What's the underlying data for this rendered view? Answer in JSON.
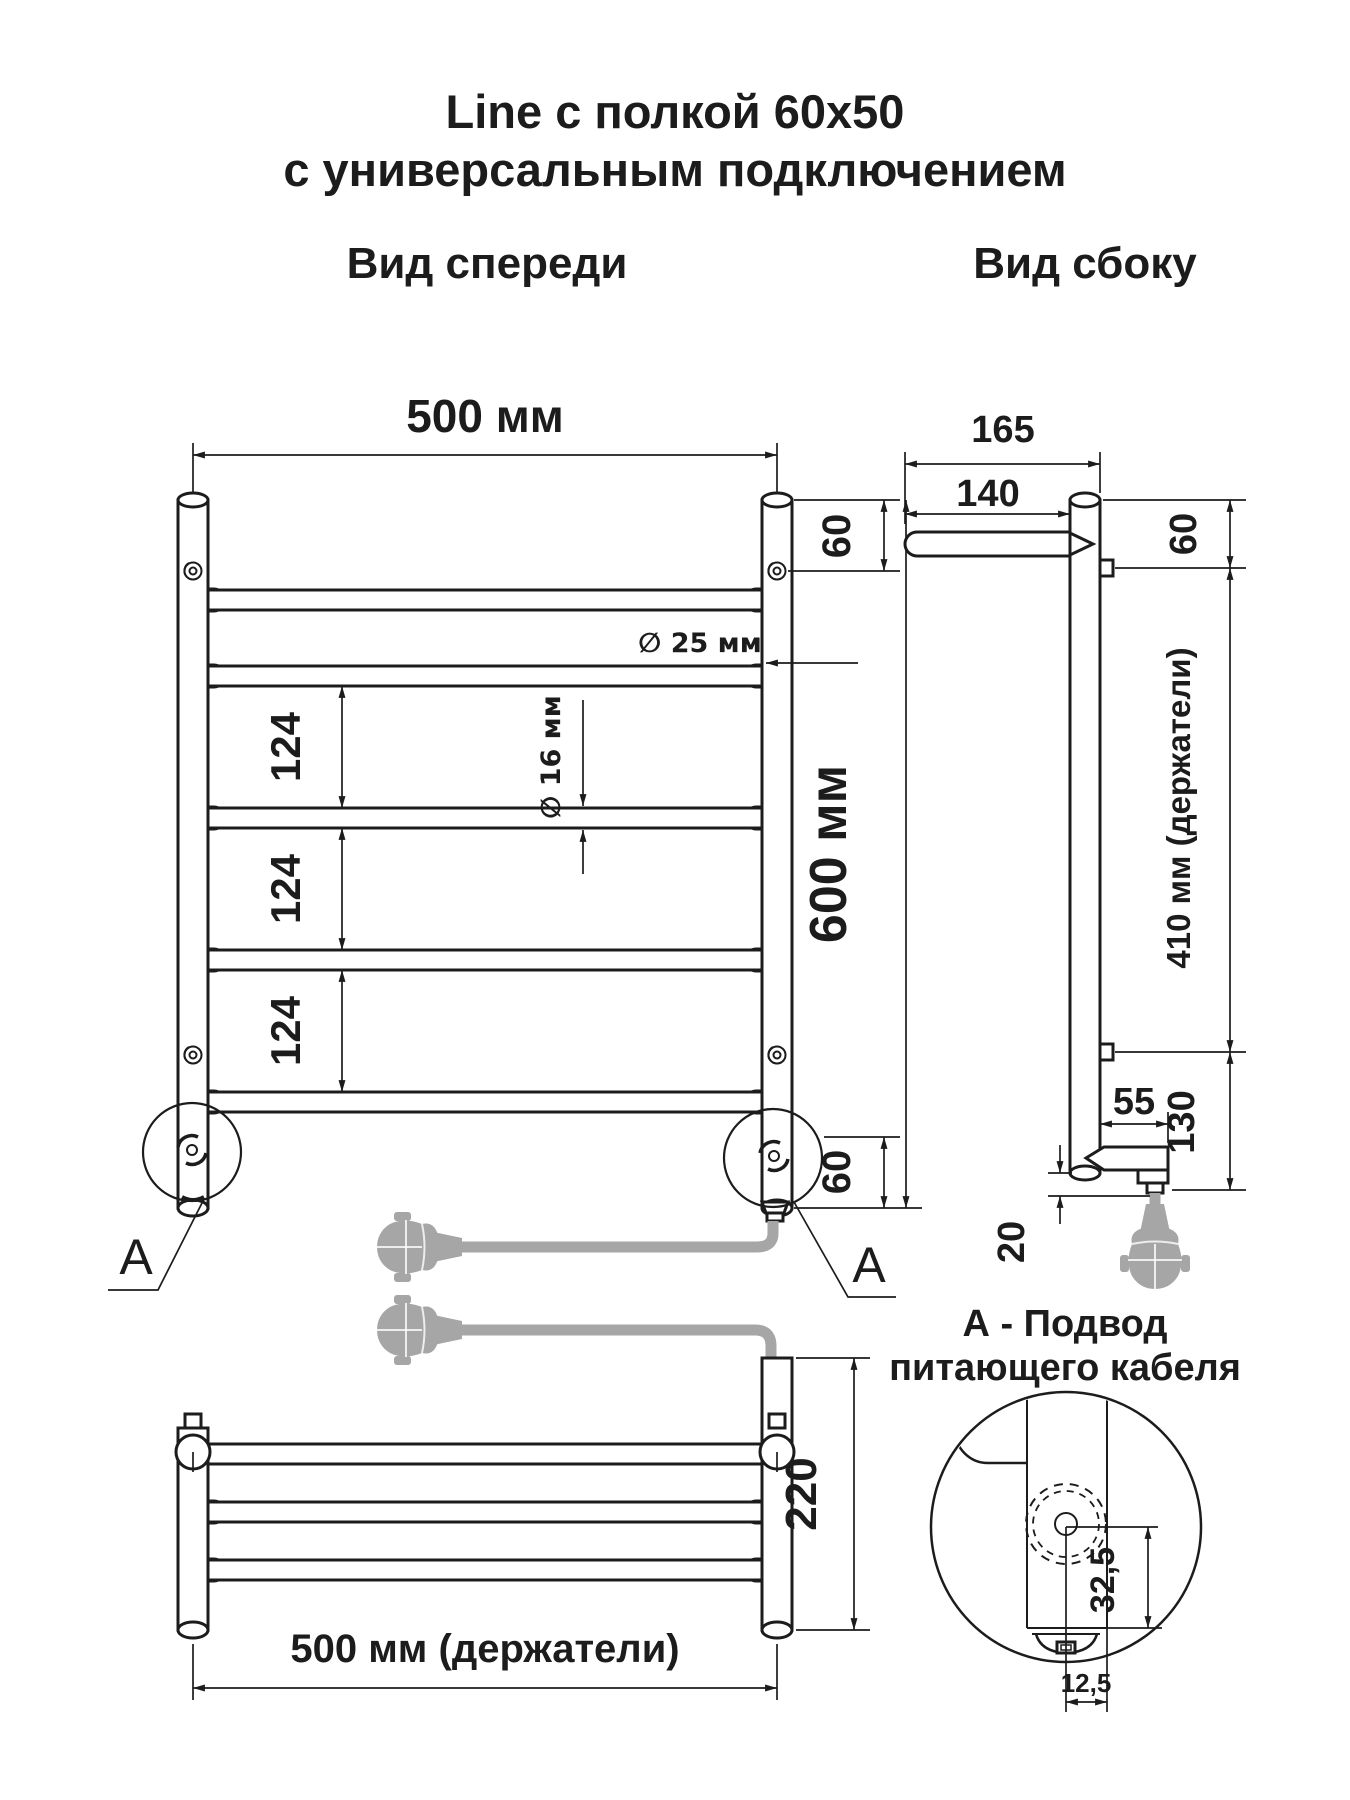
{
  "page": {
    "background": "#ffffff",
    "line_color": "#1c1c1c",
    "cable_color": "#a6a6a6"
  },
  "title": {
    "line1": "Line с полкой 60x50",
    "line2": "с универсальным подключением"
  },
  "front_view": {
    "label": "Вид спереди",
    "width_dim": "500 мм",
    "height_dim": "600 мм",
    "top_offset_dim": "60",
    "bottom_offset_dim": "60",
    "bar_gap_dims": [
      "124",
      "124",
      "124"
    ],
    "post_diameter_dim": "∅ 25 мм",
    "bar_diameter_dim": "∅ 16 мм",
    "detail_marker": "А"
  },
  "side_view": {
    "label": "Вид сбоку",
    "total_depth_dim": "165",
    "shelf_depth_dim": "140",
    "top_offset_dim": "60",
    "holders_span_dim": "410 мм (держатели)",
    "bottom_span_dim": "130",
    "bracket_width_dim": "55",
    "foot_height_dim": "20"
  },
  "shelf_view": {
    "height_dim": "220",
    "holders_width_dim": "500 мм (держатели)"
  },
  "detail_a": {
    "title_line1": "А - Подвод",
    "title_line2": "питающего кабеля",
    "vertical_offset_dim": "32,5",
    "horizontal_offset_dim": "12,5"
  }
}
